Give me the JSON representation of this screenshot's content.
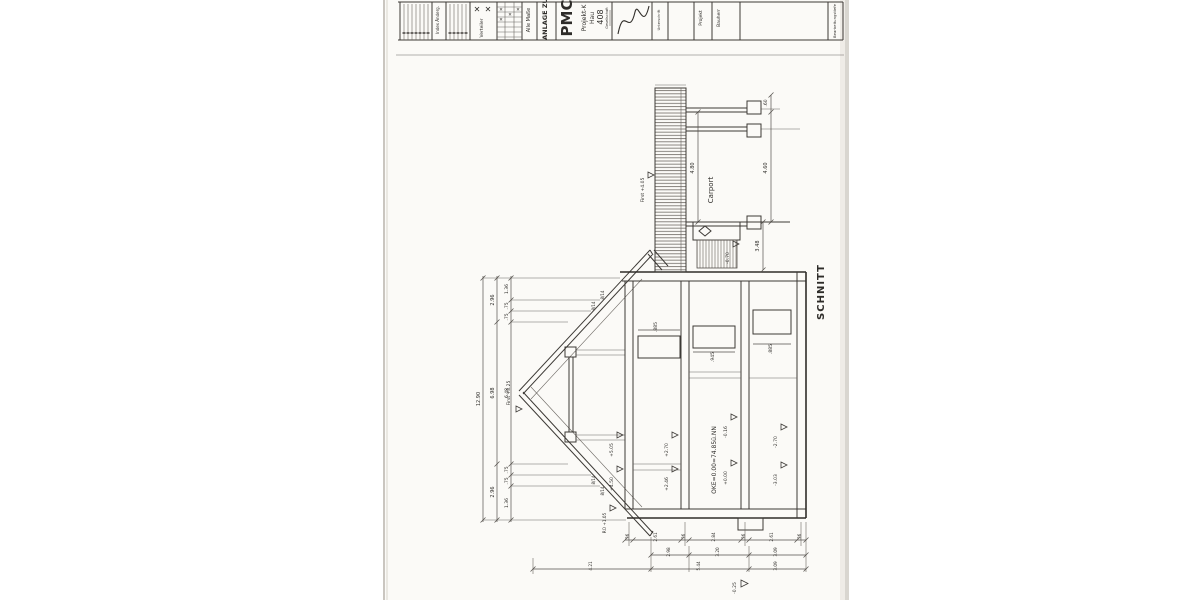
{
  "tb": {
    "index_label": "Index Änderg.",
    "verteiler": "Verteiler",
    "x_big1": "✕",
    "x_big2": "✕",
    "x_s1": "✕",
    "x_s2": "✕",
    "x_s3": "✕",
    "x_s4": "✕",
    "alle_masse": "Alle Maße",
    "anlage": "ANLAGE ZU",
    "logo_main": "PMC",
    "logo_l1": "Projekt-K",
    "logo_l2": "Hau",
    "logo_l3": "408",
    "logo_sub": "Gesellschaft",
    "unterschrift": "Unterschrift",
    "projekt": "Projekt",
    "bauherr": "Bauherr",
    "bearbeitung": "Bearbeitungstiefe"
  },
  "dw": {
    "section": "SCHNITT",
    "carport": "Carport",
    "ridge": "First +8.25",
    "carport_ridge": "First +4.05",
    "eaves": "RO +1.05",
    "oke": "OKE=0.00=74.85ü.NN",
    "lev": {
      "og_top": "+5.05",
      "og_bot": "+4.50",
      "og2_top": "+2.70",
      "og2_bot": "+2.46",
      "eg_top": "-0.16",
      "eg_bot": "+0.00",
      "kg_top": "-2.70",
      "kg_bot": "-3.03",
      "terrace": "-0.70",
      "ground": "-0.25"
    },
    "rafter1": "8/14",
    "rafter2": "8/14",
    "rafter3": "8/14",
    "rafter4": "8/14",
    "win1": ".885",
    "win2": ".945",
    "win3": ".885",
    "cp_inner": "4.80",
    "cp_outer": "4.60",
    "cp_top": ".60",
    "cp_terrace": "3.48",
    "chainA": [
      "12.90"
    ],
    "chainB": [
      "2.96",
      "6.98",
      "2.96"
    ],
    "chainC": [
      "1.36",
      ".75",
      ".75",
      "6.48",
      ".75",
      ".75",
      "1.36"
    ],
    "row1": [
      ".36",
      "2.61",
      ".36",
      "2.84",
      ".36",
      "2.61",
      ".36"
    ],
    "row2": [
      "2.98",
      "3.20",
      "3.09"
    ],
    "row3": [
      "4.21",
      "5.44",
      "3.09"
    ]
  }
}
